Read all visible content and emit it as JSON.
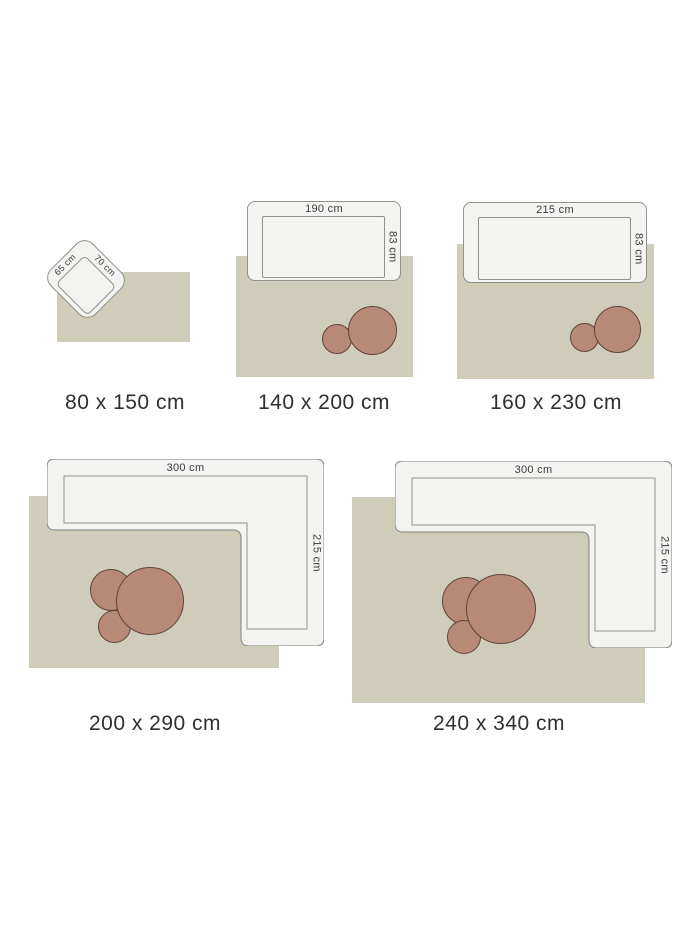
{
  "page": {
    "description": "Rug size guide diagram with furniture for scale"
  },
  "colors": {
    "background": "#ffffff",
    "rug": "#cfccba",
    "furniture_fill": "#f3f3f1",
    "furniture_stroke": "#91918b",
    "table_fill": "#b78977",
    "table_stroke": "#5e453a",
    "label_text": "#2f2f2f",
    "dimension_text": "#3c3c3c"
  },
  "tiles": [
    {
      "size_label": "80 x 150 cm",
      "furniture": "armchair",
      "dim_width": "65 cm",
      "dim_depth": "70 cm"
    },
    {
      "size_label": "140 x 200 cm",
      "furniture": "sofa",
      "dim_width": "190 cm",
      "dim_depth": "83 cm"
    },
    {
      "size_label": "160 x 230 cm",
      "furniture": "sofa",
      "dim_width": "215 cm",
      "dim_depth": "83 cm"
    },
    {
      "size_label": "200 x 290 cm",
      "furniture": "corner-sofa",
      "dim_width": "300 cm",
      "dim_depth": "215 cm"
    },
    {
      "size_label": "240 x 340 cm",
      "furniture": "corner-sofa",
      "dim_width": "300 cm",
      "dim_depth": "215 cm"
    }
  ]
}
